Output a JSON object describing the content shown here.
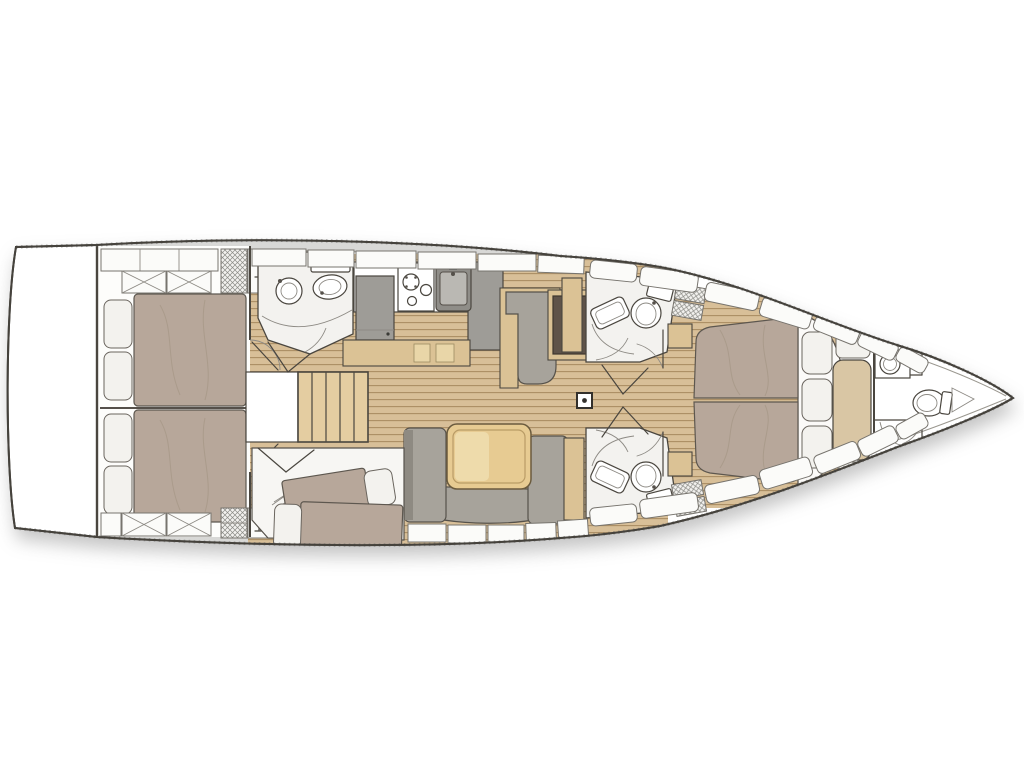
{
  "diagram": {
    "type": "yacht-interior-floor-plan",
    "orientation": "bow-right",
    "colors": {
      "outline": "#4a463f",
      "deck": "#d8d8d6",
      "hullFill": "#ffffff",
      "roomFill": "#f3f2ef",
      "lockerFill": "#fbfbf9",
      "teakBase": "#d8bf98",
      "teakStripe": "#ab8d64",
      "mattress": "#b7a79a",
      "pillow": "#f3f2ee",
      "sofa": "#a7a39b",
      "sofaDark": "#8e8a82",
      "tableTan": "#e7cb92",
      "tableInner": "#eedbab",
      "cabinetTan": "#dbc295",
      "chartBrown": "#5f5349",
      "applianceGray": "#9e9c97",
      "sinkDark": "#8f8d88",
      "stairTan": "#e4cda1"
    },
    "areas": [
      "swim-platform",
      "aft-cabin-port",
      "aft-cabin-starboard",
      "aft-head",
      "companionway-stairs",
      "galley",
      "nav-settee",
      "chart-table",
      "saloon-sofa",
      "saloon-table",
      "third-cabin",
      "mid-head-port",
      "mid-head-starboard",
      "mast-post",
      "forward-owner-cabin",
      "forward-chaise",
      "bow-head"
    ],
    "features": {
      "toilets": 4,
      "sinks": 4,
      "double_beds": 3,
      "single_beds": 2,
      "stove_burners": 2,
      "bar_glass_cabinets": 2
    }
  }
}
